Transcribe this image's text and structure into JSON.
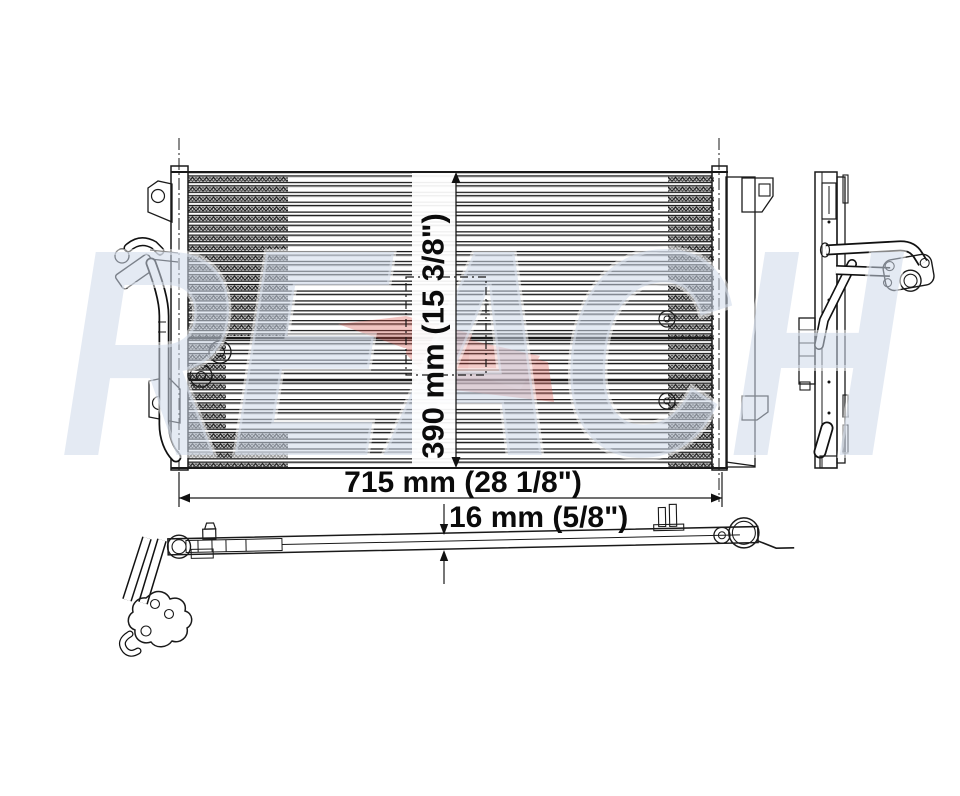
{
  "watermark": {
    "text": "REACH",
    "letter_color": "#cdd9ea",
    "swoosh_color": "#d9534a"
  },
  "dimensions": {
    "width": {
      "label": "715 mm (28 1/8\")"
    },
    "height": {
      "label": "390 mm (15 3/8\")"
    },
    "depth": {
      "label": "16 mm (5/8\")"
    }
  },
  "drawing_colors": {
    "line": "#1a1a1a",
    "background": "#ffffff"
  }
}
